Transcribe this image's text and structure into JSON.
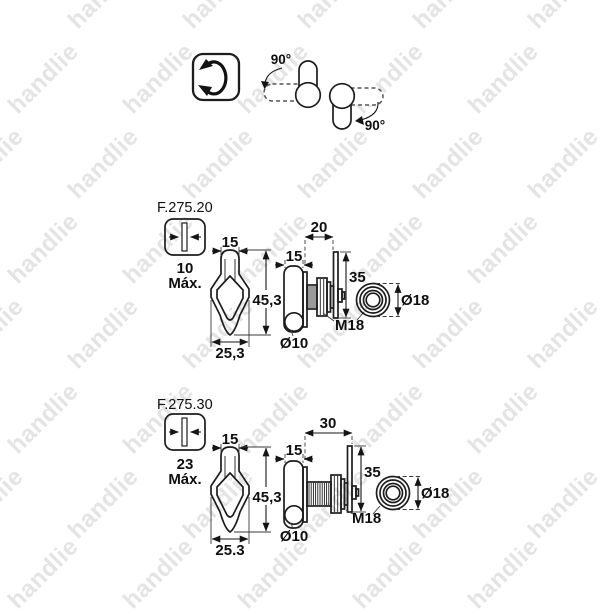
{
  "watermark": {
    "text": "handlie"
  },
  "orientation": {
    "left_angle": "90°",
    "right_angle": "90°"
  },
  "products": [
    {
      "code": "F.275.20",
      "max_thickness": {
        "value": "10",
        "suffix": "Máx."
      },
      "dims": {
        "knob_top_width": "15",
        "height": "45,3",
        "knob_width": "25,3",
        "knob_depth": "15",
        "body_length": "20",
        "cam_height": "35",
        "thread": "M18",
        "hole": "Ø10",
        "nut_diameter": "Ø18"
      }
    },
    {
      "code": "F.275.30",
      "max_thickness": {
        "value": "23",
        "suffix": "Máx."
      },
      "dims": {
        "knob_top_width": "15",
        "height": "45,3",
        "knob_width": "25.3",
        "knob_depth": "15",
        "body_length": "30",
        "cam_height": "35",
        "thread": "M18",
        "hole": "Ø10",
        "nut_diameter": "Ø18"
      }
    }
  ]
}
